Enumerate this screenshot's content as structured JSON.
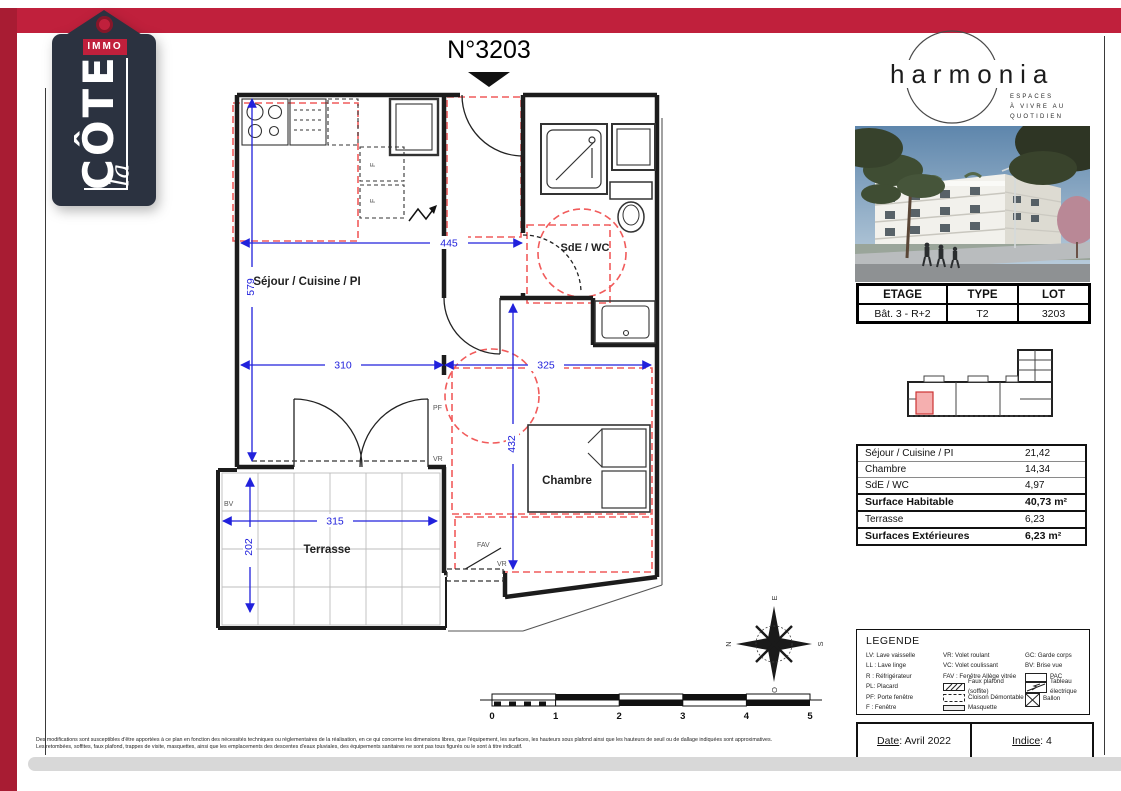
{
  "colors": {
    "brand_red": "#C0203C",
    "brand_red_dark": "#A81C33",
    "tag_navy": "#2B3240",
    "dim_blue": "#2121DC",
    "dash_red": "#F15B5B"
  },
  "brand_tag": {
    "immo": "IMMO",
    "cote": "CÔTE",
    "la": "la"
  },
  "plan": {
    "title": "N°3203",
    "rooms": {
      "sejour": "Séjour / Cuisine / PI",
      "sde": "SdE / WC",
      "chambre": "Chambre",
      "terrasse": "Terrasse"
    },
    "dims": {
      "d445": "445",
      "d579": "579",
      "d310": "310",
      "d325": "325",
      "d432": "432",
      "d315": "315",
      "d202": "202"
    },
    "tags": {
      "pf": "PF",
      "vr": "VR",
      "vr2": "VR",
      "fav": "FAV",
      "bv": "BV",
      "f1": "F",
      "f2": "F"
    }
  },
  "compass": {
    "n": "N",
    "e": "E",
    "s": "S",
    "o": "O"
  },
  "scalebar": {
    "ticks": [
      "0",
      "1",
      "2",
      "3",
      "4",
      "5"
    ]
  },
  "harmonia": {
    "name": "harmonia",
    "tagline": [
      "ESPACES",
      "À VIVRE AU",
      "QUOTIDIEN"
    ]
  },
  "info_table": {
    "headers": [
      "ETAGE",
      "TYPE",
      "LOT"
    ],
    "values": [
      "Bât. 3 - R+2",
      "T2",
      "3203"
    ]
  },
  "surface_table": {
    "rows": [
      {
        "label": "Séjour / Cuisine / PI",
        "value": "21,42"
      },
      {
        "label": "Chambre",
        "value": "14,34"
      },
      {
        "label": "SdE / WC",
        "value": "4,97"
      },
      {
        "label": "Surface Habitable",
        "value": "40,73 m²"
      },
      {
        "label": "Terrasse",
        "value": "6,23"
      },
      {
        "label": "Surfaces Extérieures",
        "value": "6,23 m²"
      }
    ]
  },
  "legend": {
    "title": "LEGENDE",
    "col1": [
      "LV: Lave vaisselle",
      "LL : Lave linge",
      "R : Réfrigérateur",
      "PL: Placard",
      "PF: Porte fenêtre",
      "F : Fenêtre"
    ],
    "col2": [
      "VR: Volet roulant",
      "VC: Volet coulissant",
      "FAV : Fenêtre Allège vitrée"
    ],
    "col2_symbols": [
      {
        "label": "Faux plafond (soffite)"
      },
      {
        "label": "Cloison Démontable"
      },
      {
        "label": "Masquette"
      }
    ],
    "col3": [
      "GC: Garde corps",
      "BV: Brise vue"
    ],
    "col3_symbols": [
      {
        "label": "PAC"
      },
      {
        "label": "Tableau électrique"
      },
      {
        "label": "Ballon"
      }
    ]
  },
  "footer": {
    "date_label": "Date",
    "date_value": " : Avril 2022",
    "indice_label": "Indice",
    "indice_value": " : 4"
  },
  "disclaimer": [
    "Des modifications sont susceptibles d'être apportées à ce plan en fonction des nécessités techniques ou réglementaires de la réalisation, en ce qui concerne les dimensions libres, que l'équipement, les surfaces, les hauteurs sous plafond ainsi que les hauteurs de seuil ou de dallage indiquées sont approximatives.",
    "Les retombées, soffites, faux plafond, trappes de visite, masquettes, ainsi que les emplacements des descentes d'eaux pluviales, des équipements sanitaires ne sont pas tous figurés ou le sont à titre indicatif."
  ]
}
